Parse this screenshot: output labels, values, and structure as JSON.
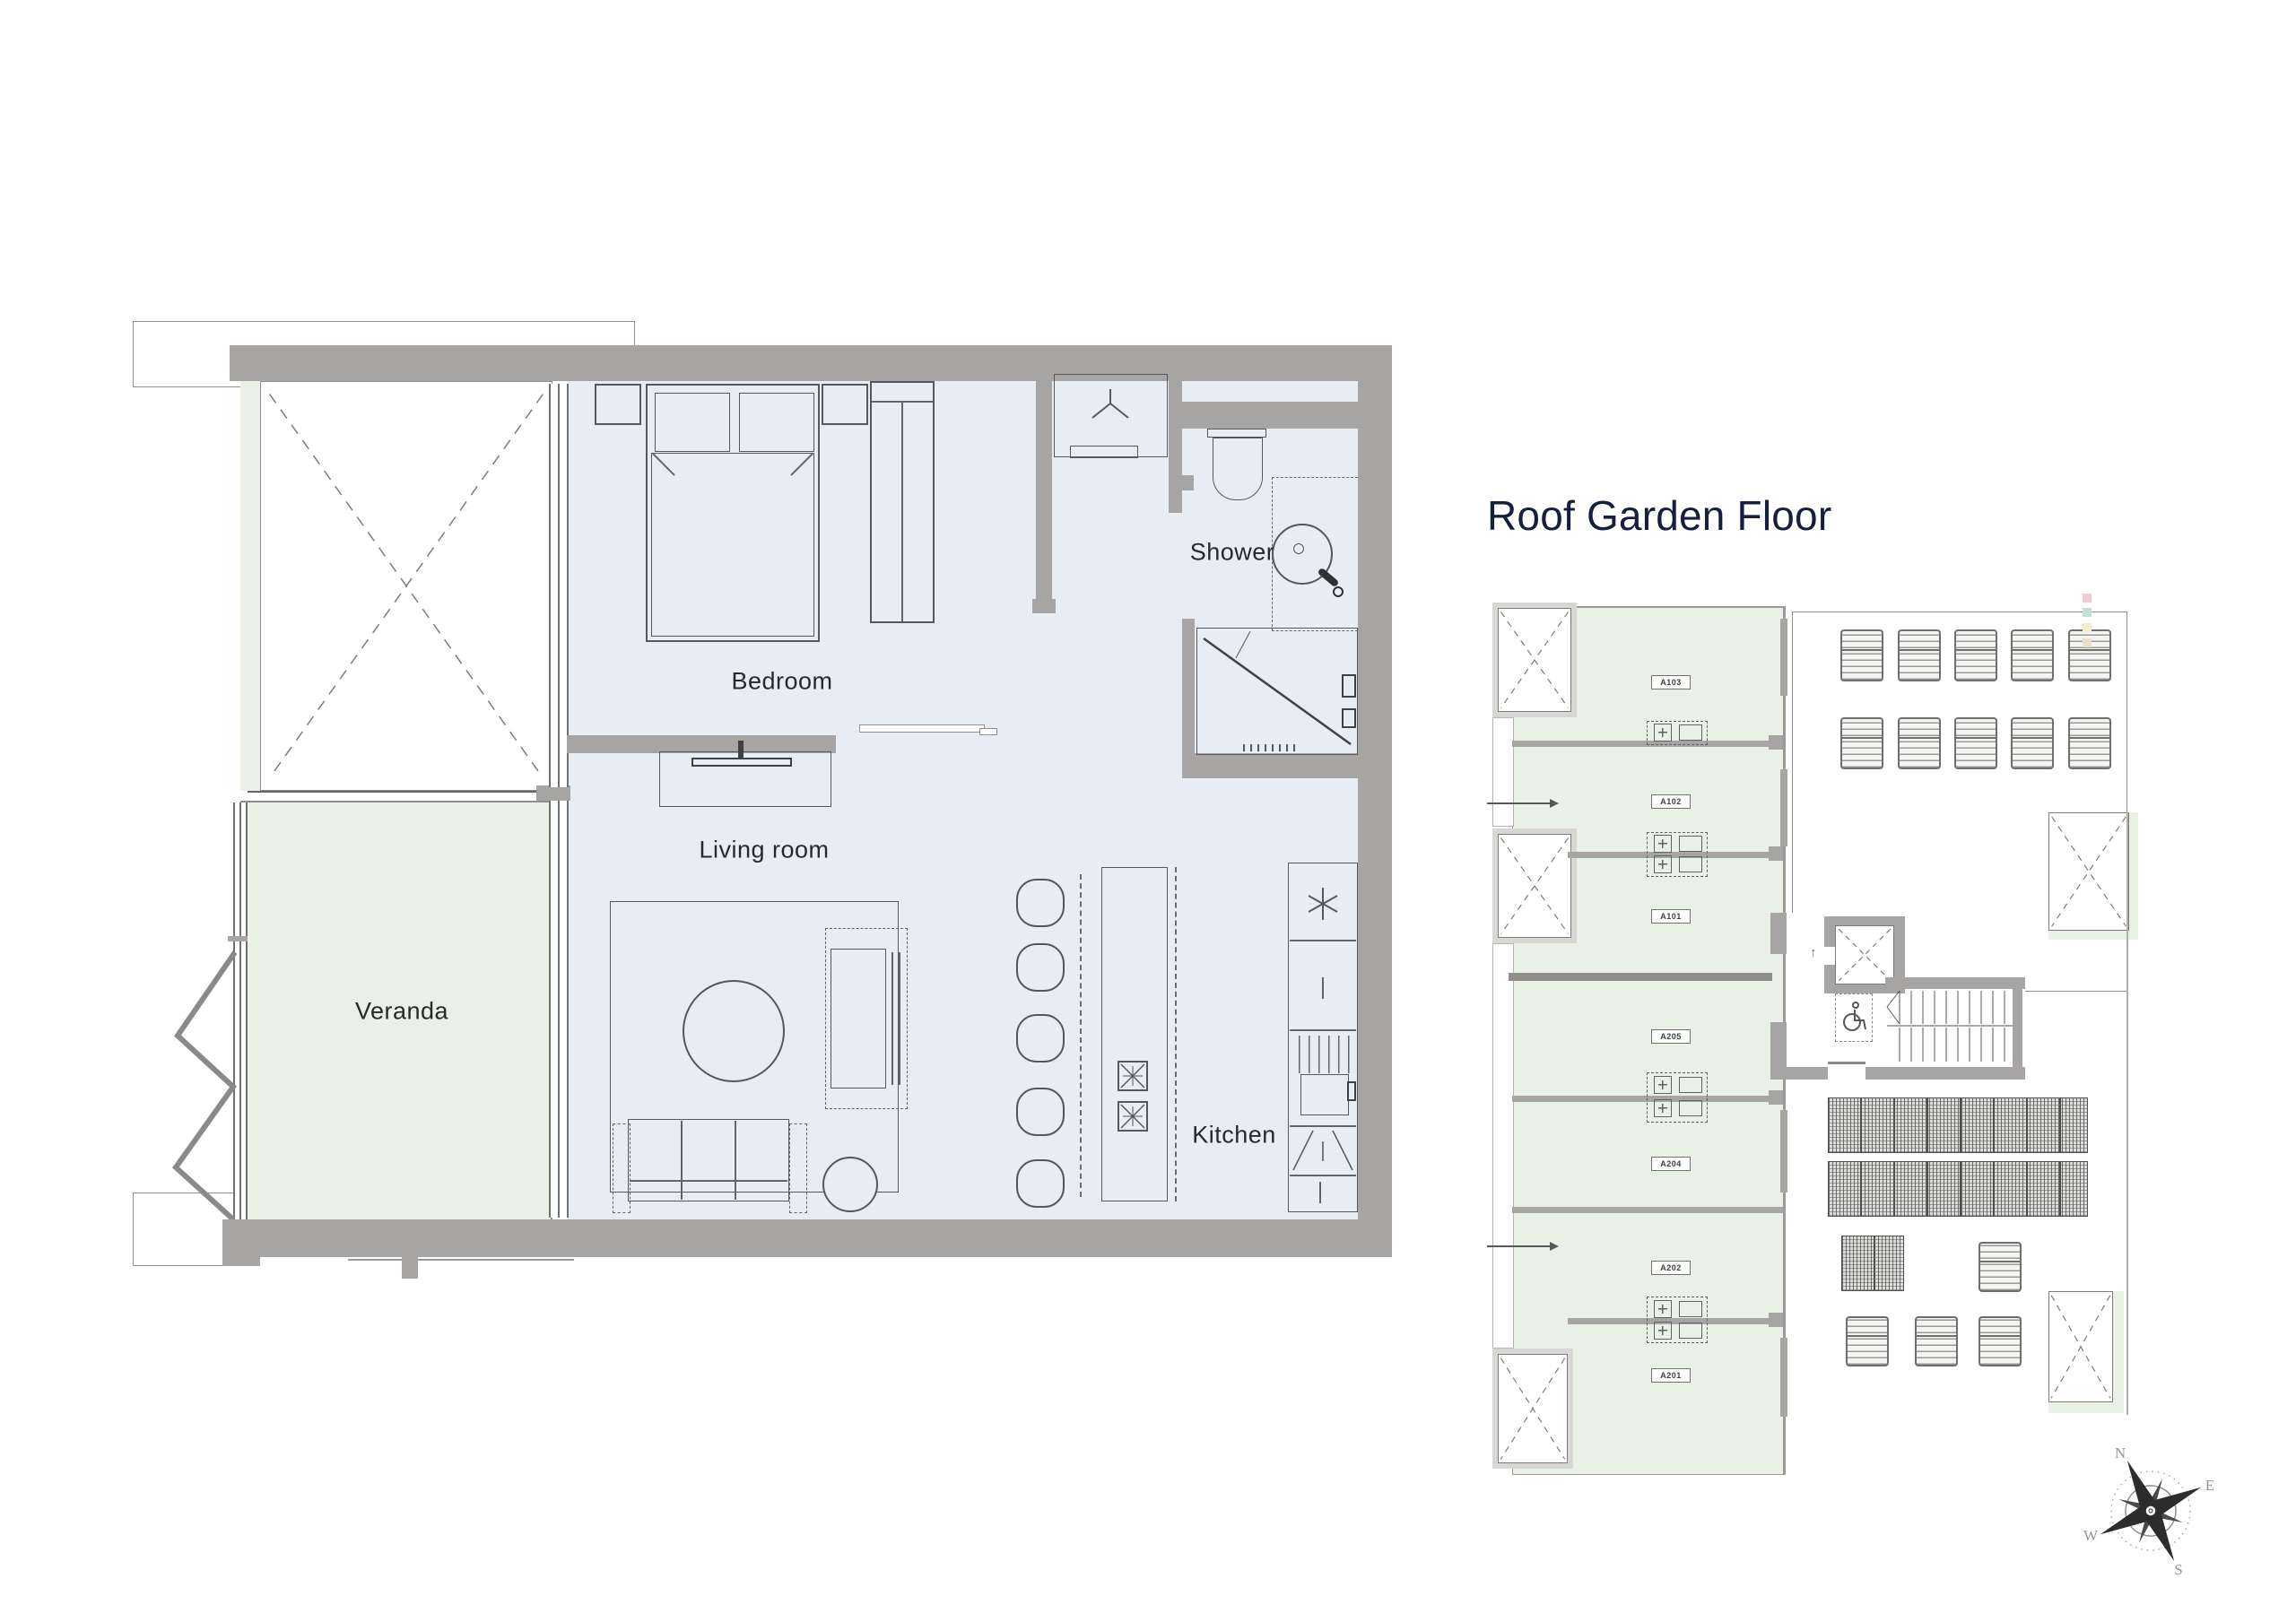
{
  "colors": {
    "wall": "#a6a5a3",
    "wall_dark": "#8f8e8c",
    "floor": "#e8edf4",
    "terrace_green": "#e9f1e7",
    "line": "#55575a",
    "title_navy": "#14203c",
    "label_dark": "#26292d"
  },
  "main_plan": {
    "labels": {
      "bedroom": "Bedroom",
      "shower": "Shower",
      "living_room": "Living room",
      "veranda": "Veranda",
      "kitchen": "Kitchen"
    }
  },
  "roof_plan": {
    "title": "Roof Garden Floor",
    "units": [
      "A103",
      "A102",
      "A101",
      "A205",
      "A204",
      "A202",
      "A201"
    ]
  },
  "compass": {
    "north": "N",
    "east": "E",
    "south": "S",
    "west": "W"
  },
  "icons": {
    "compass_rose": "compass-rose-icon",
    "wheelchair": "wheelchair-icon",
    "fridge": "fridge-star-icon",
    "coat_hook": "coat-hook-icon",
    "skylight_cross": "skylight-x-icon",
    "elevator_up_arrow": "↑"
  }
}
